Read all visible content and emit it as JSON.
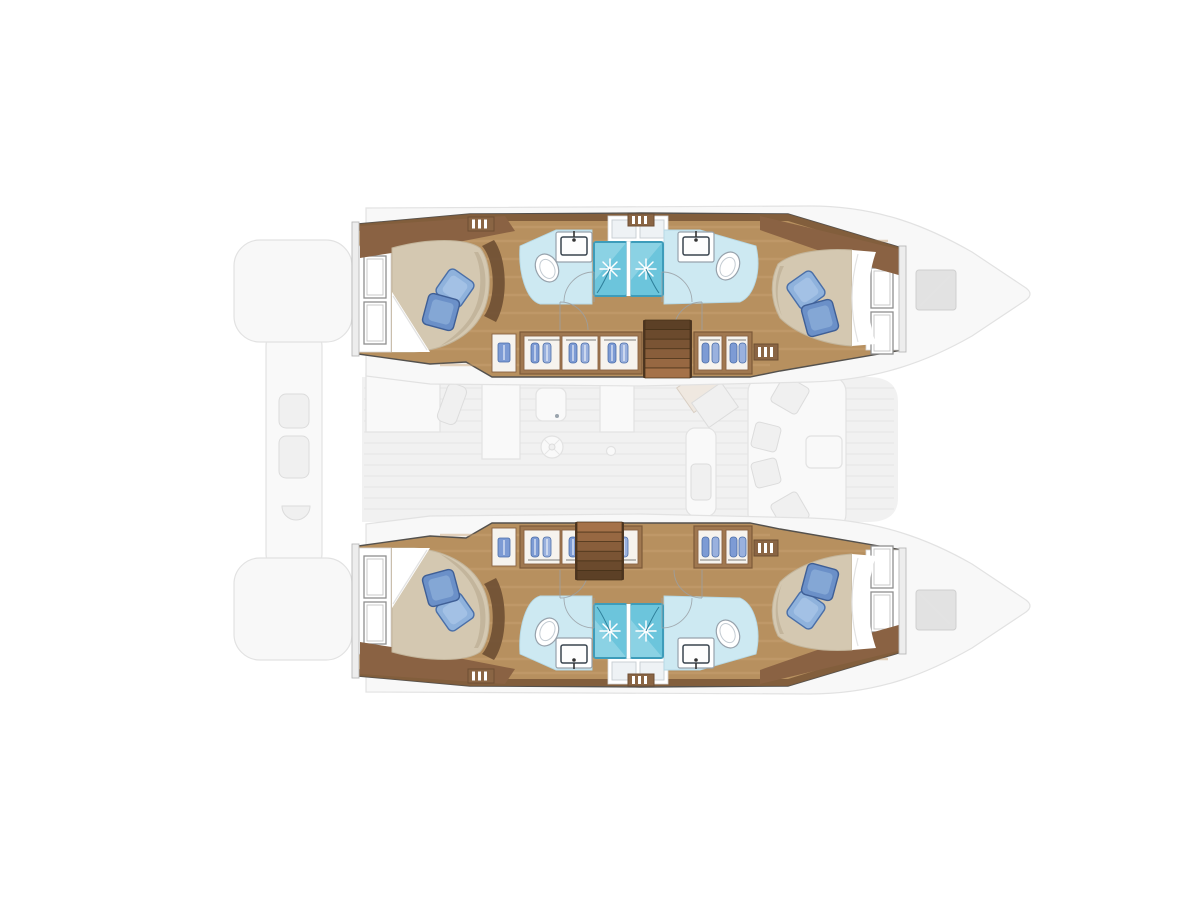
{
  "meta": {
    "title": "Catamaran yacht layout plan — top-down deck & cabin view",
    "diagram_type": "boat floor plan",
    "visible_text": "none"
  },
  "vessel": {
    "orientation": "bow pointing right, stern at left",
    "hulls": [
      "port-hull (top)",
      "starboard-hull (bottom)"
    ],
    "counts": {
      "double_cabins": 4,
      "bathrooms": 4,
      "shower_stalls": 4,
      "toilets": 4,
      "sinks": 4,
      "staircases": 2,
      "wardrobe_units": 6
    },
    "areas": [
      {
        "name": "port-aft-cabin",
        "kind": "double berth with blue pillows"
      },
      {
        "name": "port-bathrooms",
        "kind": "two shower rooms with toilets and sinks"
      },
      {
        "name": "port-forward-cabin",
        "kind": "double berth with blue pillows"
      },
      {
        "name": "starboard-aft-cabin",
        "kind": "double berth with blue pillows"
      },
      {
        "name": "starboard-bathrooms",
        "kind": "two shower rooms with toilets and sinks"
      },
      {
        "name": "starboard-forward-cabin",
        "kind": "double berth with blue pillows"
      },
      {
        "name": "bridgedeck-salon",
        "kind": "faded upper-deck overlay: galley, table, nav station, forward lounge"
      },
      {
        "name": "aft-cockpit",
        "kind": "faded upper-deck overlay with seats"
      },
      {
        "name": "bow-tips",
        "kind": "faint hull bows with deck hatches"
      }
    ]
  },
  "palette": {
    "pageBg": "#ffffff",
    "deckFaint": "#eeeeee",
    "deckShape": "#f9f9f9",
    "deckStroke": "#e2e2e2",
    "deckLine": "#e4e4e4",
    "silhouette": "#f8f8f8",
    "bowHatch": "#e2e2e2",
    "bowHatchStroke": "#cfcfcf",
    "hullStroke": "#54514d",
    "wood": "#b7905f",
    "woodStreak": "#caa274",
    "woodDark": "#7d5a39",
    "woodMid": "#a07850",
    "woodDeep": "#6e4f33",
    "trim": "#8a6243",
    "post": "#ededed",
    "postStroke": "#b9b9b9",
    "white": "#ffffff",
    "panelStroke": "#d8d8d8",
    "winFrame": "#8f8f8f",
    "mattress": "#d4c8b1",
    "mattressEdge": "#c2b49a",
    "shade": "#b4a68b",
    "pillow1": "#8fb2dc",
    "pillow1e": "#4a6fa8",
    "pillow2": "#6b90c8",
    "pillow2e": "#3f5f96",
    "bathFloor": "#cde9f2",
    "bathEdge": "#b5d8e5",
    "stall": "#6cc5dc",
    "stallHi": "#a9dfec",
    "stallEdge": "#3d9cba",
    "star": "#ffffff",
    "hose": "#2e7f9a",
    "fixture": "#ffffff",
    "fixtureStroke": "#97a2ac",
    "basinRim": "#3a454f",
    "hatch": "#eef2f5",
    "hatchStroke": "#c6ccd2",
    "wardrobeCell": "#f6f3ee",
    "clothes1": "#7d9bd4",
    "clothes2": "#9ab1de",
    "clothesEdge": "#4c6ea8",
    "grille": "#8a6544",
    "doorArc": "#9aa0a5",
    "stair1": "#5c4026",
    "stair2": "#6b4a2d",
    "stair3": "#7a5434",
    "stair4": "#895e3b",
    "stair5": "#976842",
    "stair6": "#a57249"
  }
}
